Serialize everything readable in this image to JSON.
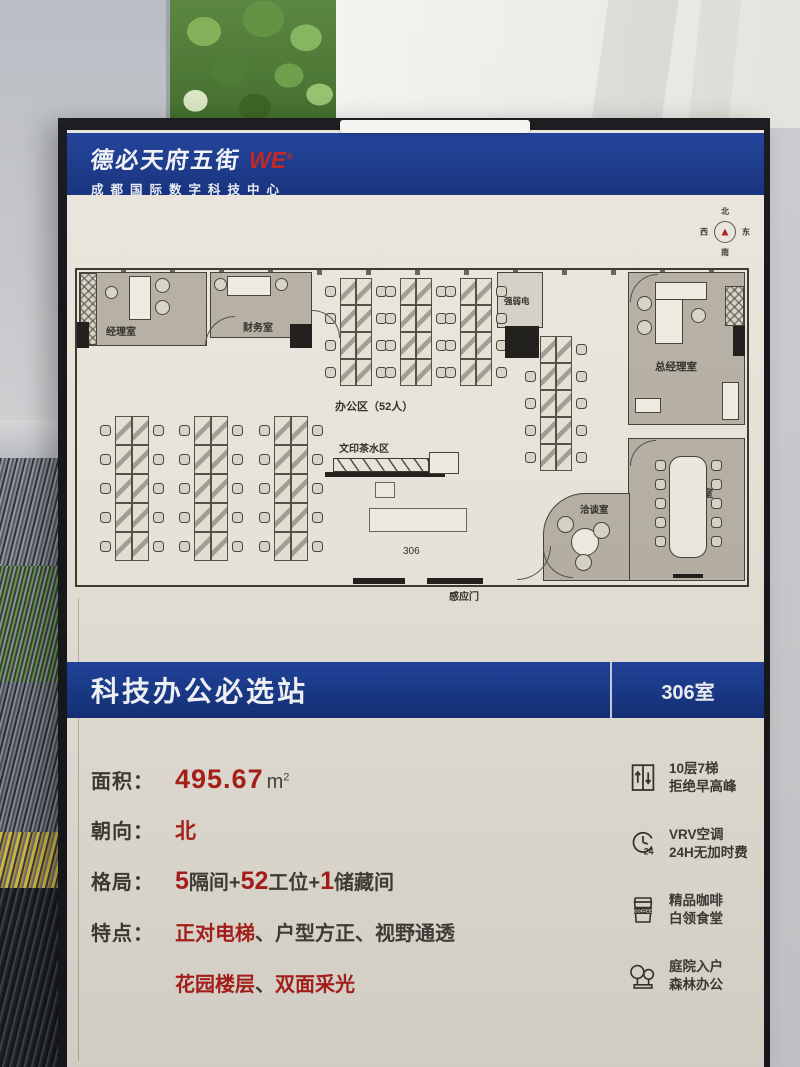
{
  "header": {
    "brand": "德必天府五街",
    "brand_mark": "WE",
    "brand_sup": "®",
    "subtitle": "成都国际数字科技中心"
  },
  "compass": {
    "n": "北",
    "e": "东",
    "s": "南",
    "w": "西",
    "arrow": "▲"
  },
  "banner": {
    "title": "科技办公必选站",
    "room": "306室"
  },
  "specs": {
    "area_label": "面积：",
    "area_value": "495.67",
    "area_unit": "m",
    "area_unit_sup": "2",
    "facing_label": "朝向：",
    "facing_value": "北",
    "layout_label": "格局：",
    "layout_parts": [
      {
        "t": "5",
        "red": true
      },
      {
        "t": "隔间+"
      },
      {
        "t": "52",
        "red": true
      },
      {
        "t": "工位+"
      },
      {
        "t": "1",
        "red": true
      },
      {
        "t": "储藏间"
      }
    ],
    "features_label": "特点：",
    "features_line1": [
      {
        "t": "正对电梯",
        "red": true
      },
      {
        "t": "、"
      },
      {
        "t": "户型方正"
      },
      {
        "t": "、"
      },
      {
        "t": "视野通透"
      }
    ],
    "features_line2": [
      {
        "t": "花园楼层",
        "red": true
      },
      {
        "t": "、"
      },
      {
        "t": "双面采光",
        "red": true
      }
    ]
  },
  "amenities": [
    {
      "icon": "elevator-icon",
      "line1": "10层7梯",
      "line2": "拒绝早高峰"
    },
    {
      "icon": "clock-24-icon",
      "line1": "VRV空调",
      "line2": "24H无加时费"
    },
    {
      "icon": "coffee-icon",
      "line1": "精品咖啡",
      "line2": "白领食堂",
      "icon_text": "COFFEE"
    },
    {
      "icon": "trees-icon",
      "line1": "庭院入户",
      "line2": "森林办公"
    }
  ],
  "floor_plan": {
    "rooms": [
      {
        "id": "manager",
        "label": "经理室",
        "x": 2,
        "y": 2,
        "w": 128,
        "h": 74,
        "lx": 26,
        "ly": 50,
        "fs": 10
      },
      {
        "id": "finance",
        "label": "财务室",
        "x": 133,
        "y": 2,
        "w": 102,
        "h": 66,
        "lx": 32,
        "ly": 46,
        "fs": 10
      },
      {
        "id": "electrical",
        "label": "强弱电",
        "x": 420,
        "y": 2,
        "w": 46,
        "h": 56,
        "lx": 6,
        "ly": 22,
        "fs": 8.5,
        "fill": "#d6d1c6"
      },
      {
        "id": "gm",
        "label": "总经理室",
        "x": 551,
        "y": 2,
        "w": 117,
        "h": 153,
        "lx": 26,
        "ly": 86,
        "fs": 10.5
      },
      {
        "id": "meeting",
        "label": "会议室",
        "x": 551,
        "y": 168,
        "w": 117,
        "h": 143,
        "lx": 54,
        "ly": 46,
        "fs": 10
      },
      {
        "id": "talk",
        "label": "洽谈室",
        "x": 466,
        "y": 223,
        "w": 87,
        "h": 88,
        "lx": 36,
        "ly": 8,
        "fs": 9.5,
        "radius": "42px 0 0 0"
      }
    ],
    "labels": [
      {
        "text": "办公区（52人）",
        "x": 258,
        "y": 128,
        "fs": 11,
        "bold": true
      },
      {
        "text": "文印茶水区",
        "x": 262,
        "y": 170,
        "fs": 10,
        "bold": true
      },
      {
        "text": "306",
        "x": 326,
        "y": 276,
        "fs": 10,
        "bold": false
      },
      {
        "text": "感应门",
        "x": 372,
        "y": 318,
        "fs": 10,
        "bold": true
      }
    ],
    "desk_banks": [
      {
        "x": 263,
        "y": 8,
        "rows": 4,
        "cw": 16,
        "ch": 27
      },
      {
        "x": 323,
        "y": 8,
        "rows": 4,
        "cw": 16,
        "ch": 27
      },
      {
        "x": 383,
        "y": 8,
        "rows": 4,
        "cw": 16,
        "ch": 27
      },
      {
        "x": 463,
        "y": 66,
        "rows": 5,
        "cw": 16,
        "ch": 27
      },
      {
        "x": 38,
        "y": 146,
        "rows": 5,
        "cw": 17,
        "ch": 29
      },
      {
        "x": 117,
        "y": 146,
        "rows": 5,
        "cw": 17,
        "ch": 29
      },
      {
        "x": 197,
        "y": 146,
        "rows": 5,
        "cw": 17,
        "ch": 29
      }
    ],
    "furniture": [
      {
        "type": "hatch",
        "x": 3,
        "y": 3,
        "w": 17,
        "h": 72
      },
      {
        "type": "rect",
        "x": 52,
        "y": 6,
        "w": 22,
        "h": 44
      },
      {
        "type": "circle",
        "x": 78,
        "y": 8,
        "d": 15
      },
      {
        "type": "circle",
        "x": 78,
        "y": 30,
        "d": 15
      },
      {
        "type": "circle",
        "x": 28,
        "y": 16,
        "d": 13
      },
      {
        "type": "rect",
        "x": 150,
        "y": 6,
        "w": 44,
        "h": 20
      },
      {
        "type": "circle",
        "x": 137,
        "y": 8,
        "d": 13
      },
      {
        "type": "circle",
        "x": 198,
        "y": 8,
        "d": 13
      },
      {
        "type": "dark",
        "x": 0,
        "y": 52,
        "w": 12,
        "h": 26
      },
      {
        "type": "dark",
        "x": 213,
        "y": 54,
        "w": 22,
        "h": 24
      },
      {
        "type": "dark",
        "x": 428,
        "y": 56,
        "w": 34,
        "h": 32
      },
      {
        "type": "dark",
        "x": 656,
        "y": 56,
        "w": 12,
        "h": 30
      },
      {
        "type": "hatch",
        "x": 648,
        "y": 16,
        "w": 19,
        "h": 40
      },
      {
        "type": "rect",
        "x": 578,
        "y": 12,
        "w": 28,
        "h": 62
      },
      {
        "type": "rect",
        "x": 578,
        "y": 12,
        "w": 52,
        "h": 18
      },
      {
        "type": "circle",
        "x": 560,
        "y": 26,
        "d": 15
      },
      {
        "type": "circle",
        "x": 560,
        "y": 50,
        "d": 15
      },
      {
        "type": "circle",
        "x": 614,
        "y": 38,
        "d": 15
      },
      {
        "type": "rect",
        "x": 645,
        "y": 112,
        "w": 17,
        "h": 38
      },
      {
        "type": "rect",
        "x": 558,
        "y": 128,
        "w": 26,
        "h": 15
      },
      {
        "type": "table",
        "x": 592,
        "y": 186,
        "w": 38,
        "h": 102
      },
      {
        "type": "chairs-col",
        "x": 578,
        "y": 190,
        "count": 5,
        "dy": 19
      },
      {
        "type": "chairs-col",
        "x": 634,
        "y": 190,
        "count": 5,
        "dy": 19
      },
      {
        "type": "dark",
        "x": 596,
        "y": 304,
        "w": 30,
        "h": 4
      },
      {
        "type": "circle",
        "x": 494,
        "y": 258,
        "d": 28,
        "light": true
      },
      {
        "type": "circle",
        "x": 480,
        "y": 246,
        "d": 17
      },
      {
        "type": "circle",
        "x": 516,
        "y": 252,
        "d": 17
      },
      {
        "type": "circle",
        "x": 498,
        "y": 284,
        "d": 17
      },
      {
        "type": "counter",
        "x": 256,
        "y": 188,
        "w": 96,
        "h": 14
      },
      {
        "type": "dark",
        "x": 248,
        "y": 202,
        "w": 120,
        "h": 5
      },
      {
        "type": "rect",
        "x": 352,
        "y": 182,
        "w": 30,
        "h": 22
      },
      {
        "type": "outline",
        "x": 298,
        "y": 212,
        "w": 20,
        "h": 16
      },
      {
        "type": "outline",
        "x": 292,
        "y": 238,
        "w": 98,
        "h": 24
      },
      {
        "type": "dark",
        "x": 276,
        "y": 308,
        "w": 52,
        "h": 6
      },
      {
        "type": "dark",
        "x": 350,
        "y": 308,
        "w": 56,
        "h": 6
      }
    ],
    "arcs": [
      {
        "x": 128,
        "y": 46,
        "s": 30,
        "rot": 0
      },
      {
        "x": 235,
        "y": 40,
        "s": 28,
        "rot": 90
      },
      {
        "x": 553,
        "y": 4,
        "s": 28,
        "rot": 0
      },
      {
        "x": 553,
        "y": 170,
        "s": 26,
        "rot": 0
      },
      {
        "x": 440,
        "y": 276,
        "s": 34,
        "rot": 180
      },
      {
        "x": 466,
        "y": 278,
        "s": 30,
        "rot": 270
      }
    ]
  },
  "colors": {
    "blue": "#1d3d8f",
    "red": "#a91f1b",
    "ink": "#3c3a35",
    "room_fill": "#b7b1a5"
  }
}
